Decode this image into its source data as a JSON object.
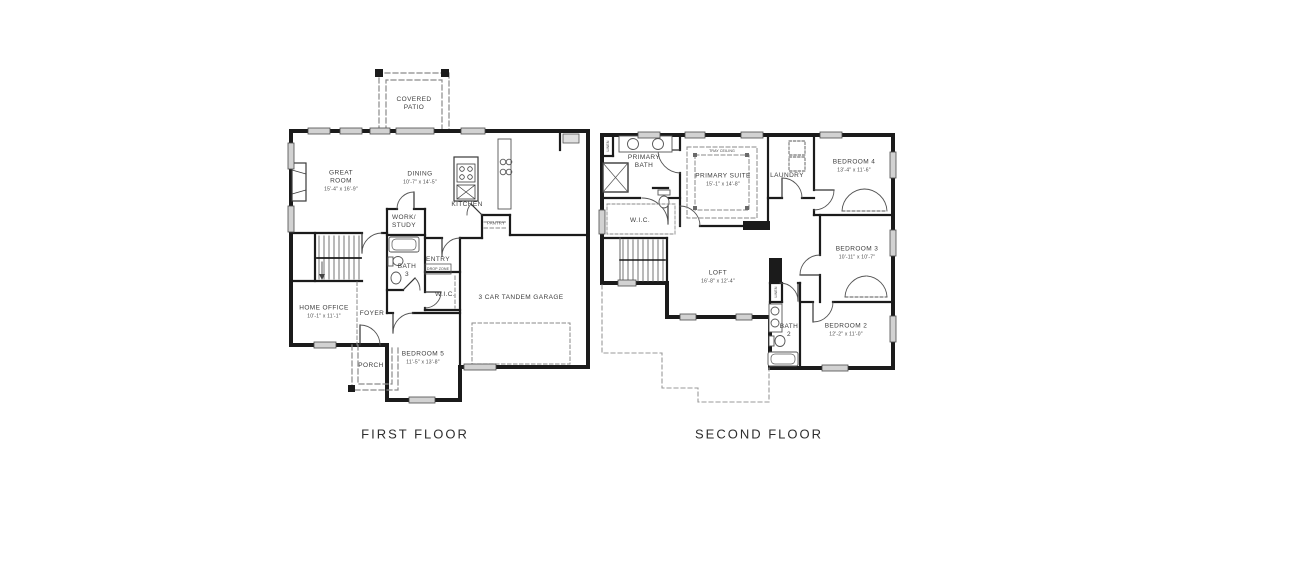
{
  "document": {
    "type": "residential floor plan drawing",
    "background": "#ffffff",
    "colors": {
      "wall": "#1b1b1b",
      "window_fill": "#d2d2d2",
      "fixture_line": "#4a4a4a",
      "dashed_line": "#8a8a8a",
      "label_text": "#3d3d3d",
      "title_text": "#2e2e2e"
    }
  },
  "first_floor": {
    "title": "FIRST FLOOR",
    "rooms": {
      "covered_patio": {
        "name": "COVERED\nPATIO"
      },
      "great_room": {
        "name": "GREAT\nROOM",
        "dims": "15'-4\" x 16'-9\""
      },
      "dining": {
        "name": "DINING",
        "dims": "10'-7\" x 14'-5\""
      },
      "kitchen": {
        "name": "KITCHEN"
      },
      "work_study": {
        "name": "WORK/\nSTUDY"
      },
      "pantry": {
        "name": "PANTRY"
      },
      "entry": {
        "name": "ENTRY"
      },
      "drop_zone": {
        "name": "DROP ZONE"
      },
      "bath_3": {
        "name": "BATH\n3"
      },
      "wic": {
        "name": "W.I.C."
      },
      "home_office": {
        "name": "HOME OFFICE",
        "dims": "10'-1\" x 11'-1\""
      },
      "foyer": {
        "name": "FOYER"
      },
      "porch": {
        "name": "PORCH"
      },
      "bedroom_5": {
        "name": "BEDROOM 5",
        "dims": "11'-5\" x 13'-8\""
      },
      "garage": {
        "name": "3 CAR TANDEM GARAGE"
      }
    }
  },
  "second_floor": {
    "title": "SECOND FLOOR",
    "rooms": {
      "primary_bath": {
        "name": "PRIMARY\nBATH"
      },
      "primary_suite": {
        "name": "PRIMARY SUITE",
        "dims": "15'-1\" x 14'-8\""
      },
      "tray_ceiling": {
        "name": "TRAY CEILING"
      },
      "laundry": {
        "name": "LAUNDRY"
      },
      "bedroom_4": {
        "name": "BEDROOM 4",
        "dims": "13'-4\" x 11'-6\""
      },
      "wic": {
        "name": "W.I.C."
      },
      "loft": {
        "name": "LOFT",
        "dims": "16'-8\" x 12'-4\""
      },
      "bedroom_3": {
        "name": "BEDROOM 3",
        "dims": "10'-11\" x 10'-7\""
      },
      "bath_2": {
        "name": "BATH\n2"
      },
      "bedroom_2": {
        "name": "BEDROOM 2",
        "dims": "12'-2\" x 11'-0\""
      },
      "linen_bath": {
        "name": "LINEN"
      },
      "linen_hall": {
        "name": "LINEN"
      }
    }
  }
}
